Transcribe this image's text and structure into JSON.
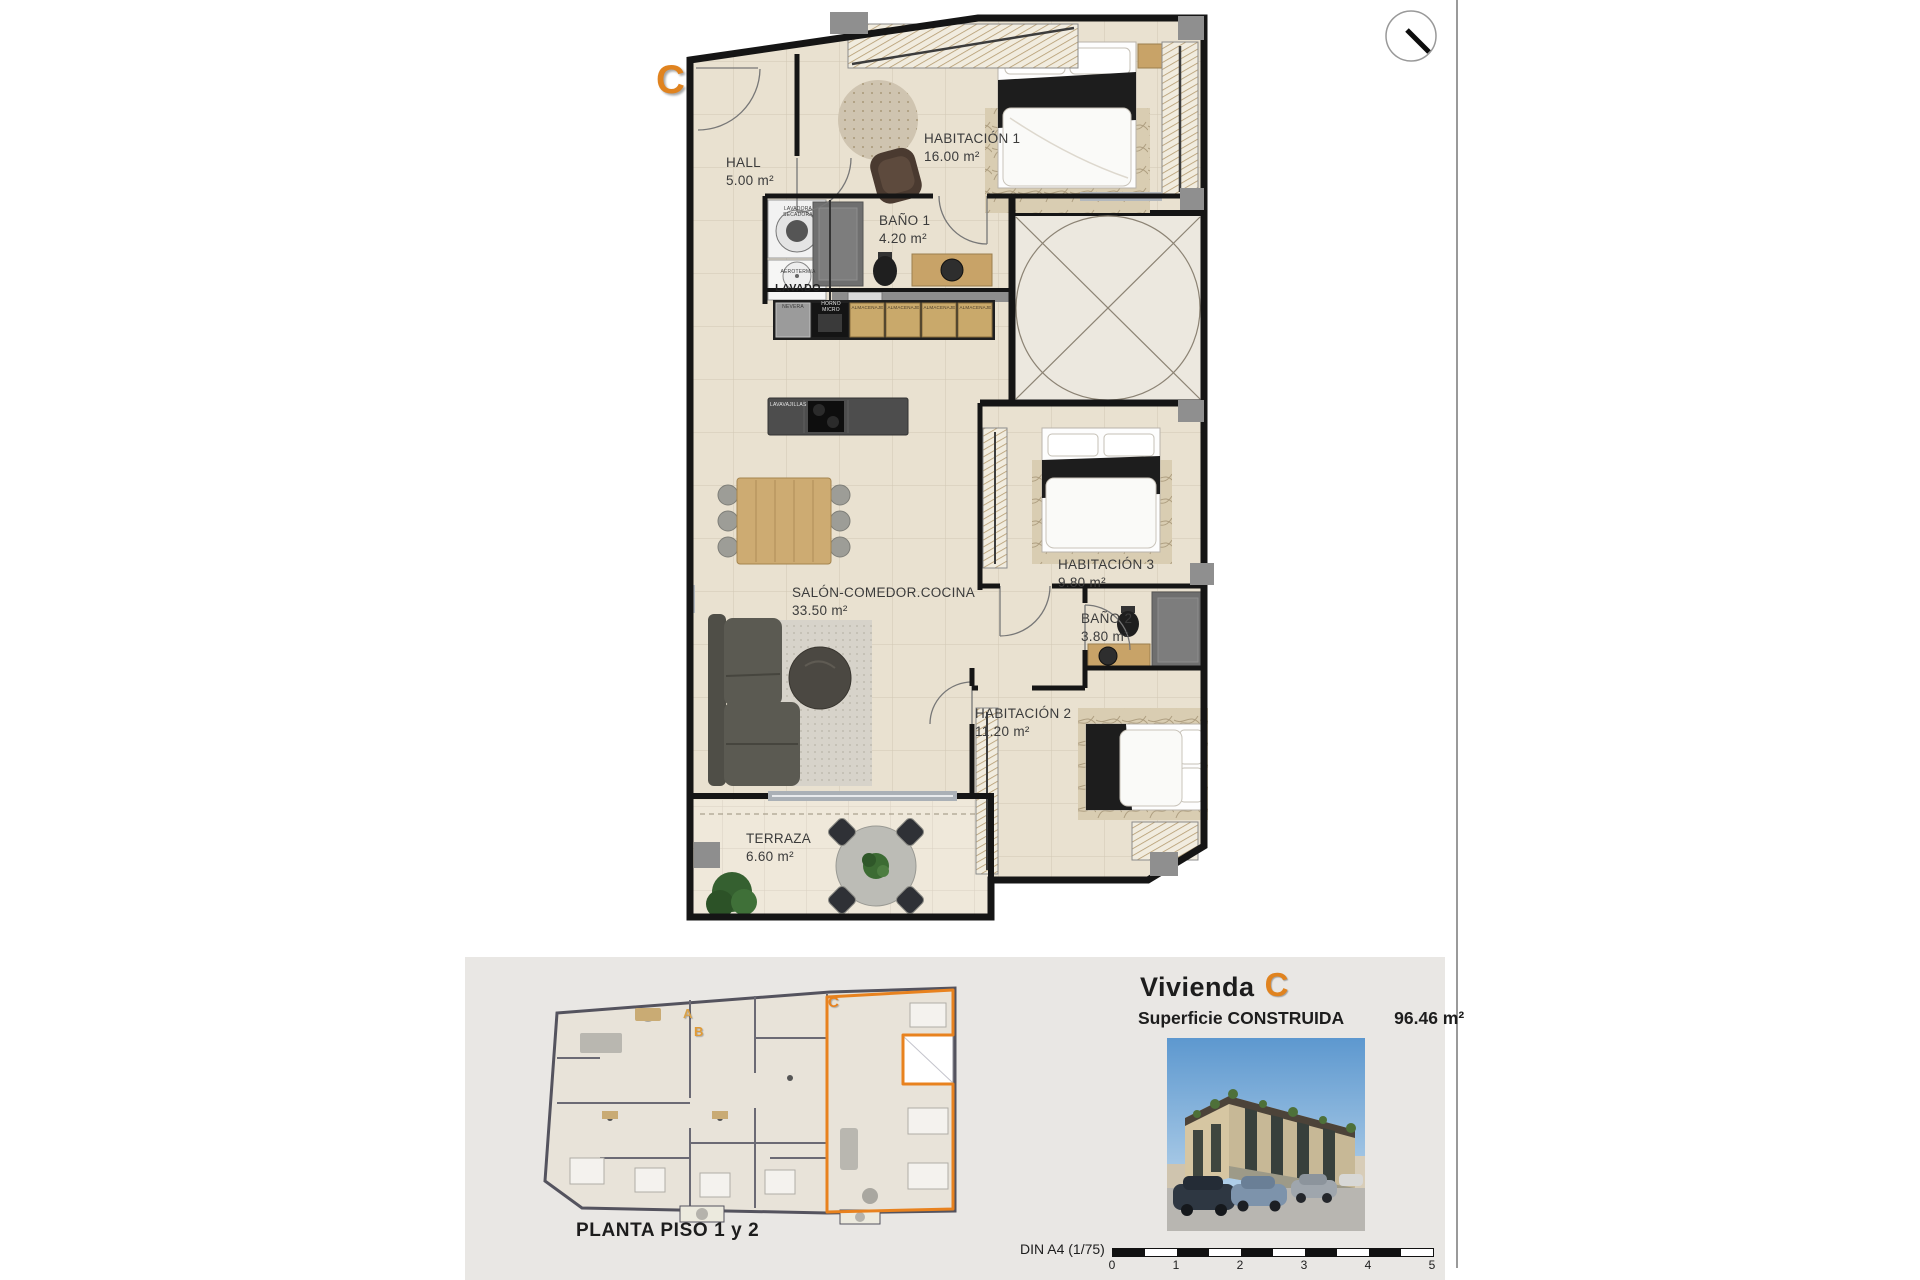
{
  "page": {
    "unit_marker": "C",
    "plan": {
      "rooms": [
        {
          "name": "HALL",
          "area": "5.00 m²"
        },
        {
          "name": "HABITACIÓN 1",
          "area": "16.00 m²"
        },
        {
          "name": "BAÑO 1",
          "area": "4.20 m²"
        },
        {
          "name": "SALÓN-COMEDOR.COCINA",
          "area": "33.50 m²"
        },
        {
          "name": "HABITACIÓN 3",
          "area": "9.80 m²"
        },
        {
          "name": "BAÑO 2",
          "area": "3.80 m²"
        },
        {
          "name": "HABITACIÓN 2",
          "area": "11.20 m²"
        },
        {
          "name": "TERRAZA",
          "area": "6.60 m²"
        }
      ],
      "appliances": {
        "lavadora": "LAVADORA",
        "secadora": "SECADORA",
        "aerotermia": "AEROTERMIA",
        "lavado": "LAVADO",
        "nevera": "NEVERA",
        "horno": "HORNO",
        "micro": "MICRO",
        "almacenaje": "ALMACENAJE",
        "lavavajillas": "LAVAVAJILLAS"
      }
    },
    "footer": {
      "plan_caption": "PLANTA PISO 1 y 2",
      "title_prefix": "Vivienda",
      "title_letter": "C",
      "surface_label": "Superficie CONSTRUIDA",
      "surface_value": "96.46 m²",
      "scale_label": "DIN A4 (1/75)",
      "scale_ticks": [
        "0",
        "1",
        "2",
        "3",
        "4",
        "5"
      ],
      "overview_letters": {
        "a": "A",
        "b": "B",
        "c": "C"
      }
    },
    "colors": {
      "accent_orange": "#e0831f",
      "wall_black": "#151515",
      "floor_beige": "#e9e1d0",
      "wood": "#c8a368",
      "band_gray": "#e9e7e4"
    }
  }
}
